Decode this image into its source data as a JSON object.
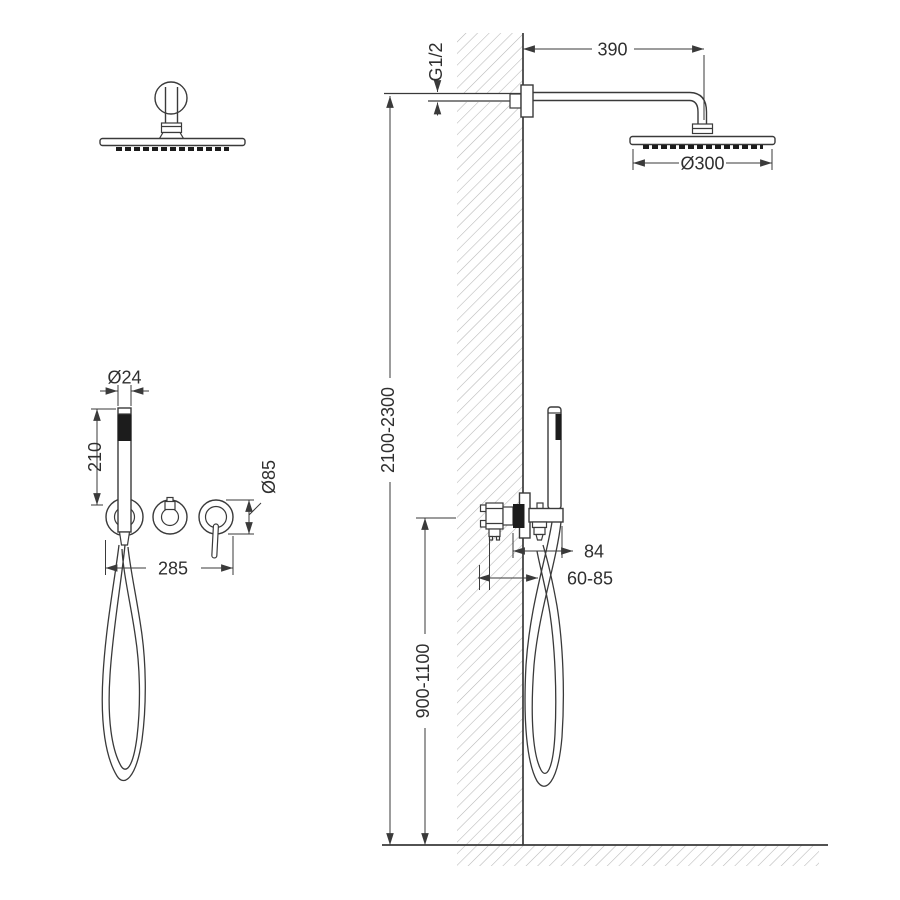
{
  "drawing": {
    "labels": {
      "arm_length": "390",
      "supply_thread": "G1/2",
      "head_diameter": "Ø300",
      "install_height": "2100-2300",
      "handshower_diameter": "Ø24",
      "handshower_length": "210",
      "trim_diameter": "Ø85",
      "trim_spacing": "285",
      "holder_projection": "84",
      "rough_in_depth": "60-85",
      "mixer_height": "900-1100"
    },
    "colors": {
      "line": "#3a3a3a",
      "dark_fill": "#1c1c1c",
      "hatch": "#b6b6b6",
      "background": "#ffffff"
    }
  }
}
